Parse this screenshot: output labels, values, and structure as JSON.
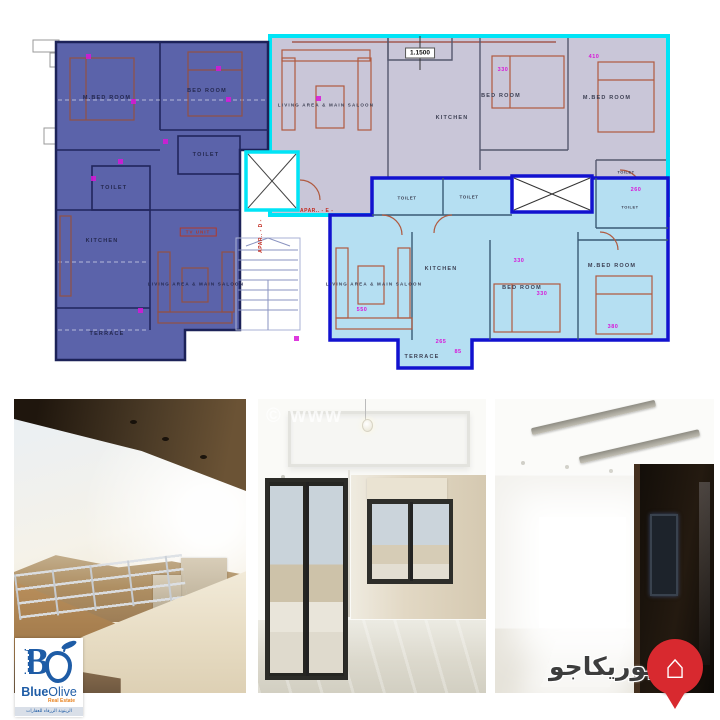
{
  "floor_plan": {
    "dim_note": "1.1500",
    "apt_d_label": "APAR.. - D -",
    "apt_e_label": "APAR.. - E -",
    "purple": {
      "fill": "#5b63aa",
      "mbed": "M.BED ROOM",
      "bed": "BED ROOM",
      "toilet_a": "TOILET",
      "toilet_b": "TOILET",
      "kitchen": "KITCHEN",
      "tv_unit": "TV UNIT",
      "living": "LIVING AREA & MAIN SALOON",
      "terrace": "TERRACE"
    },
    "lavender": {
      "fill": "#c9c6d8",
      "border": "#00e4f6",
      "living": "LIVING AREA & MAIN SALOON",
      "kitchen": "KITCHEN",
      "bed": "BED ROOM",
      "mbed": "M.BED ROOM",
      "toilet": "TOILET",
      "dim_bed": "330",
      "dim_mbed": "410",
      "dim_toilet": "260"
    },
    "blue": {
      "fill": "#b5dff2",
      "border": "#1212cf",
      "toilet_a": "TOILET",
      "toilet_b": "TOILET",
      "toilet_c": "TOILET",
      "living": "LIVING AREA & MAIN SALOON",
      "kitchen": "KITCHEN",
      "bed": "BED ROOM",
      "mbed": "M.BED ROOM",
      "terrace": "TERRACE",
      "dim_living": "550",
      "dim_top": "330",
      "dim_bed": "330",
      "dim_mbed": "380",
      "dim_terrace_a": "265",
      "dim_terrace_b": "85"
    }
  },
  "photos": {
    "watermark": "© www",
    "captions": [
      "balcony terrace view",
      "empty living room",
      "empty bedroom with dark doorway"
    ]
  },
  "branding": {
    "blue_olive": {
      "letter": "B",
      "name_first": "Blue",
      "name_second": "Olive",
      "subtitle": "Real Estate",
      "tagline_ar": "الزيتونة الزرقاء للعقارات",
      "brand_blue": "#1e5ca6",
      "accent_orange": "#e8821e"
    },
    "yurikago": {
      "name_ar": "يوريكاجو",
      "pin_red": "#d8292f"
    }
  }
}
